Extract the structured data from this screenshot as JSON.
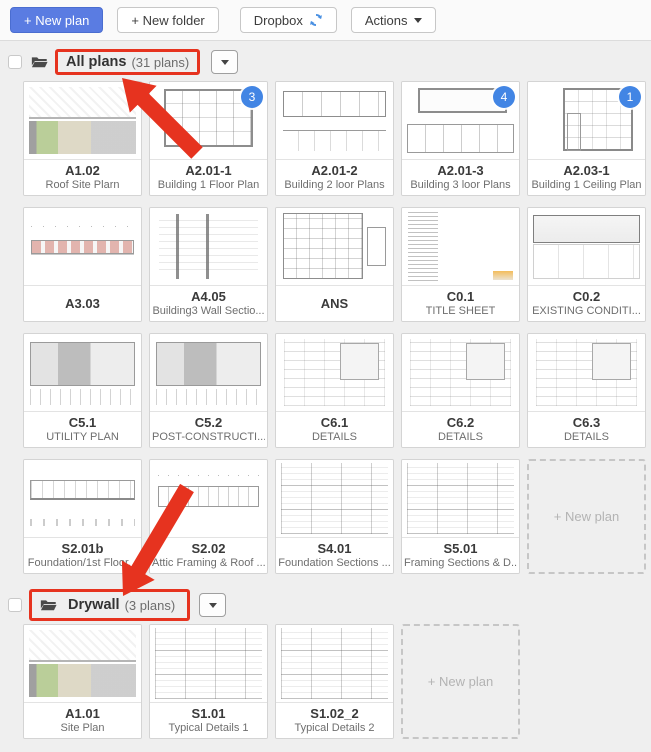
{
  "colors": {
    "primary_blue": "#5a7ce2",
    "badge_blue": "#4285e4",
    "annotation_red": "#e6331f",
    "refresh_blue": "#4a90e2"
  },
  "toolbar": {
    "new_plan": "+ New plan",
    "new_folder": "+ New folder",
    "dropbox": "Dropbox",
    "actions": "Actions"
  },
  "sections": [
    {
      "name": "All plans",
      "count_label": "(31 plans)",
      "highlighted": true,
      "highlight_scope": "title",
      "new_plan_placeholder": "+ New plan",
      "plans": [
        {
          "name": "A1.02",
          "subtitle": "Roof Site Plarn",
          "thumb": "site"
        },
        {
          "name": "A2.01-1",
          "subtitle": "Building 1 Floor Plan",
          "badge": "3",
          "thumb": "floor"
        },
        {
          "name": "A2.01-2",
          "subtitle": "Building 2 loor Plans",
          "thumb": "floor2"
        },
        {
          "name": "A2.01-3",
          "subtitle": "Building 3 loor Plans",
          "badge": "4",
          "thumb": "floor3"
        },
        {
          "name": "A2.03-1",
          "subtitle": "Building 1 Ceiling Plan",
          "badge": "1",
          "thumb": "ceiling"
        },
        {
          "name": "A3.03",
          "subtitle": "",
          "thumb": "elevation"
        },
        {
          "name": "A4.05",
          "subtitle": "Building3 Wall Sectio...",
          "thumb": "wall"
        },
        {
          "name": "ANS",
          "subtitle": "",
          "thumb": "plan-dense"
        },
        {
          "name": "C0.1",
          "subtitle": "TITLE SHEET",
          "thumb": "text"
        },
        {
          "name": "C0.2",
          "subtitle": "EXISTING CONDITI...",
          "thumb": "grading"
        },
        {
          "name": "C5.1",
          "subtitle": "UTILITY PLAN",
          "thumb": "civil"
        },
        {
          "name": "C5.2",
          "subtitle": "POST-CONSTRUCTI...",
          "thumb": "civil"
        },
        {
          "name": "C6.1",
          "subtitle": "DETAILS",
          "thumb": "details"
        },
        {
          "name": "C6.2",
          "subtitle": "DETAILS",
          "thumb": "details"
        },
        {
          "name": "C6.3",
          "subtitle": "DETAILS",
          "thumb": "details"
        },
        {
          "name": "S2.01b",
          "subtitle": "Foundation/1st Floor...",
          "thumb": "foundation"
        },
        {
          "name": "S2.02",
          "subtitle": "Attic Framing & Roof ...",
          "thumb": "framing"
        },
        {
          "name": "S4.01",
          "subtitle": "Foundation Sections ...",
          "thumb": "details-grid"
        },
        {
          "name": "S5.01",
          "subtitle": "Framing Sections & D...",
          "thumb": "details-grid"
        }
      ]
    },
    {
      "name": "Drywall",
      "count_label": "(3 plans)",
      "highlighted": true,
      "highlight_scope": "with-icon",
      "new_plan_placeholder": "+ New plan",
      "plans": [
        {
          "name": "A1.01",
          "subtitle": "Site Plan",
          "thumb": "site"
        },
        {
          "name": "S1.01",
          "subtitle": "Typical Details 1",
          "thumb": "details-grid"
        },
        {
          "name": "S1.02_2",
          "subtitle": "Typical Details 2",
          "thumb": "details-grid"
        }
      ]
    }
  ]
}
